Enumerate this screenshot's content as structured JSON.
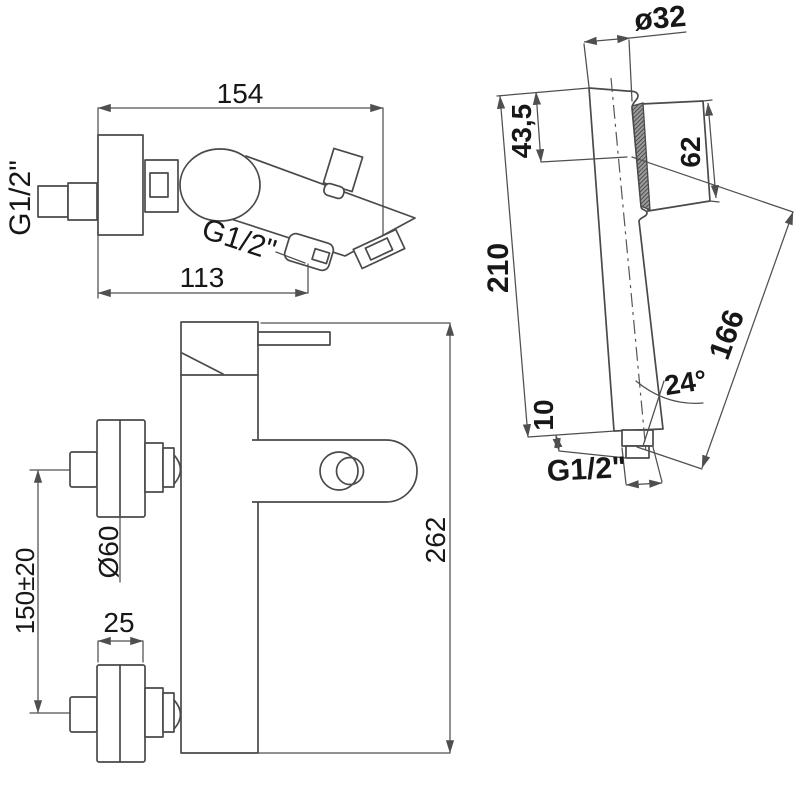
{
  "drawing": {
    "type": "technical-dimension-drawing",
    "subject": "wall-mounted single-lever bath mixer with hand shower",
    "colors": {
      "line": "#4a4a4a",
      "text": "#171717",
      "background": "#ffffff"
    },
    "side_view": {
      "dim_width": "154",
      "dim_spout_reach": "113",
      "label_inlet_thread": "G1/2\"",
      "label_spout_thread": "G1/2\""
    },
    "front_view": {
      "dim_height": "262",
      "dim_escutcheon_diameter": "Ø60",
      "dim_inlet_spacing": "150±20",
      "dim_escutcheon_width": "25"
    },
    "hand_shower": {
      "dim_head_diameter": "ø32",
      "dim_head_depth": "43,5",
      "dim_head_width": "62",
      "dim_total_length": "210",
      "dim_face_length": "166",
      "dim_spray_angle": "24°",
      "dim_connector_length": "10",
      "label_thread": "G1/2\""
    }
  }
}
